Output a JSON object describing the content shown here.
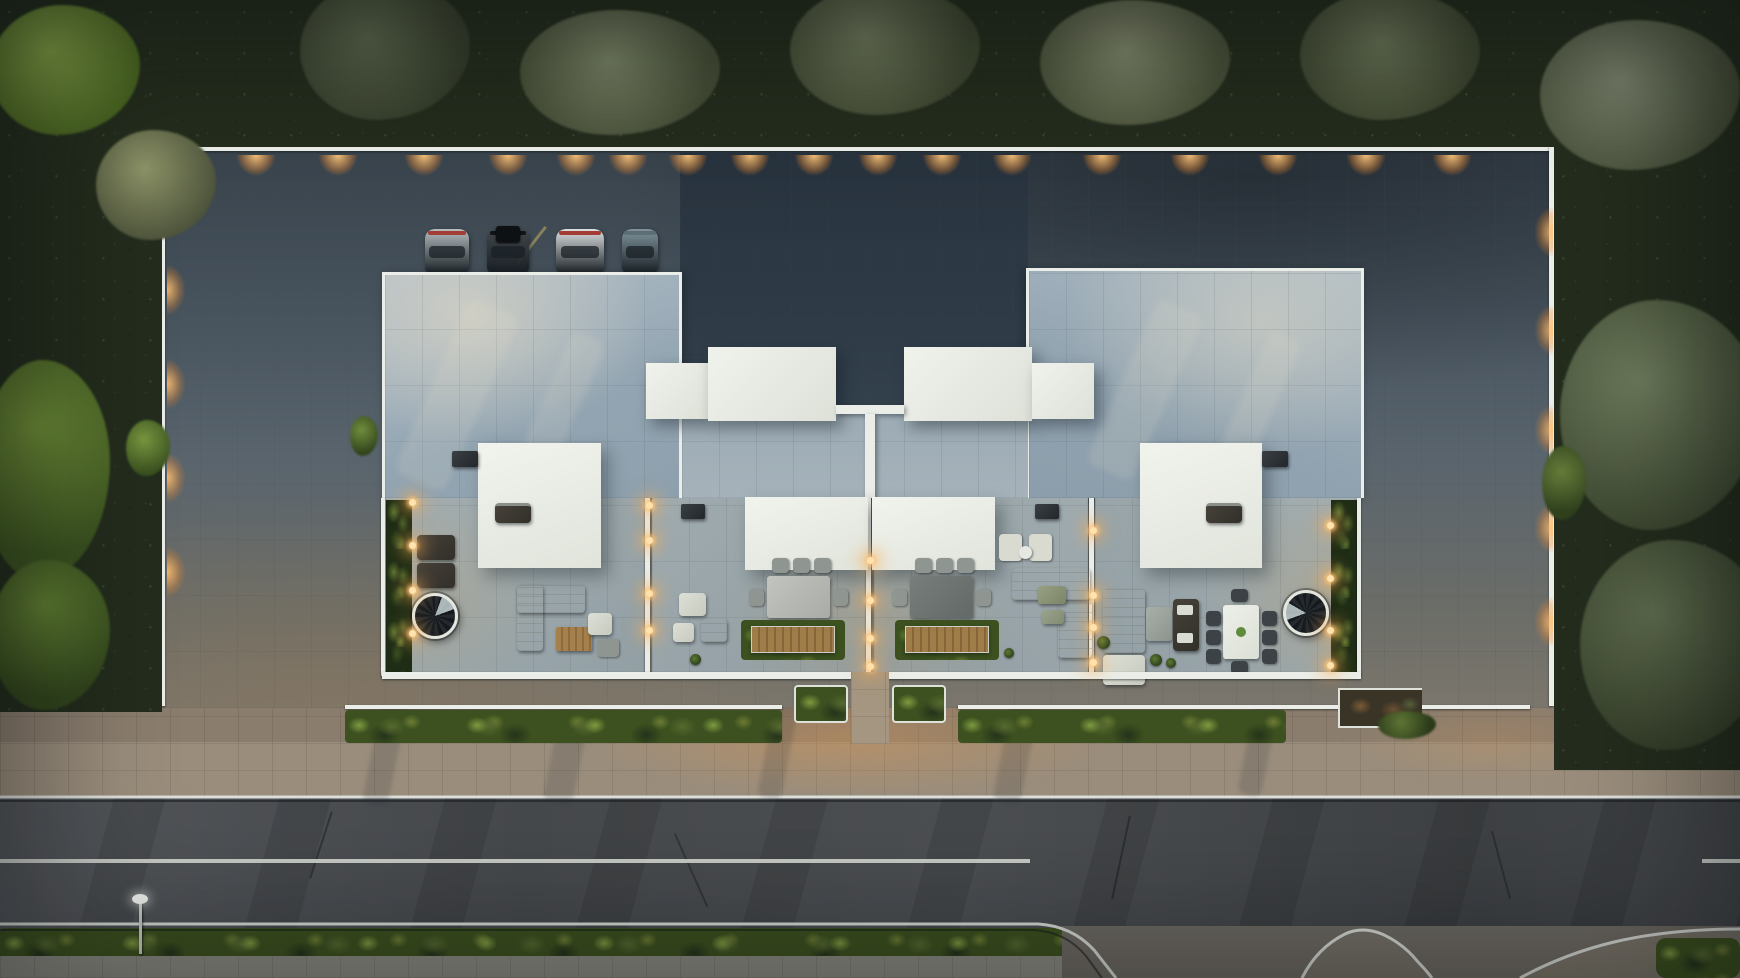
{
  "meta": {
    "description": "Aerial top-down 3D architectural visualization at dusk: a modern flat-roof residential complex with four terraced units inside a white-walled plot, surrounded by tree belts, fronted by a hedge-lined sidewalk and an asphalt road with a junction at lower right",
    "time_of_day": "dusk",
    "view": "top-down aerial",
    "visible_text": "none"
  },
  "palette": {
    "foliage-dark": "#232c1d",
    "foliage-olive": "#4e5a40",
    "foliage-bright": "#6d8c3a",
    "concrete-dark": "#3d4750",
    "concrete-mid": "#5a656e",
    "concrete-warm": "#7a746a",
    "courtyard": "#2b3843",
    "roof-tile": "#9fb0bc",
    "roof-cream": "#cbcfc6",
    "white-structure": "#eaede8",
    "terrace-tile": "#9aa7ab",
    "hedge-green": "#3c511f",
    "hedge-light": "#7e9a40",
    "sidewalk": "#9a8d7c",
    "verge": "#8a7d6e",
    "road": "#47494c",
    "road-line": "#d8dbd7",
    "glow-warm": "#ffb45e"
  },
  "counts": {
    "residential_units": 4,
    "parked_cars": 4,
    "rooftop_boxes": 4,
    "canopies": 4,
    "spiral_staircases": 2,
    "dining_sets": 3,
    "front_hedge_strips": 2,
    "entry_planters": 2,
    "street_lamps": 1,
    "lane_lines": 3
  },
  "lights": {
    "top_wall_y": 155,
    "top_wall_x": [
      256,
      338,
      424,
      508,
      576,
      628,
      688,
      750,
      814,
      878,
      942,
      1012,
      1102,
      1190,
      1278,
      1366,
      1452
    ],
    "left_wall_x": 167,
    "left_wall_y": [
      196,
      290,
      384,
      478,
      572
    ],
    "right_wall_x": 1533,
    "right_wall_y": [
      232,
      330,
      430,
      528,
      622
    ],
    "divider_columns": [
      {
        "x": 412,
        "ys": [
          502,
          545,
          590,
          633
        ]
      },
      {
        "x": 649,
        "ys": [
          505,
          540,
          593,
          630
        ]
      },
      {
        "x": 870,
        "ys": [
          560,
          600,
          638,
          666
        ]
      },
      {
        "x": 1093,
        "ys": [
          530,
          595,
          627,
          662
        ]
      },
      {
        "x": 1330,
        "ys": [
          525,
          578,
          630,
          665
        ]
      }
    ]
  },
  "cars": [
    {
      "x": 425,
      "w": 44,
      "body": "#b6bdc1",
      "accent": "#a33c34",
      "roof_box": false
    },
    {
      "x": 487,
      "w": 42,
      "body": "#41464b",
      "accent": "#111315",
      "roof_box": true
    },
    {
      "x": 556,
      "w": 48,
      "body": "#dde1e2",
      "accent": "#a33c34",
      "roof_box": false
    },
    {
      "x": 622,
      "w": 36,
      "body": "#7f949c",
      "accent": "#5d6e75",
      "roof_box": false
    }
  ],
  "street": {
    "lane_line_segments_x": [
      [
        0,
        1030
      ],
      [
        1702,
        1740
      ]
    ],
    "street_lamp": {
      "x": 140,
      "y": 900
    },
    "junction": "side street mouth and curved sweep at bottom right"
  },
  "terraces": [
    {
      "id": "unit-1",
      "features": [
        "planter-strip",
        "wall-lights",
        "two-sun-loungers",
        "spiral-staircase",
        "corner-sofa",
        "wood-coffee-table",
        "side-table",
        "armchair",
        "bbq-grill",
        "vent-box",
        "white-canopy"
      ]
    },
    {
      "id": "unit-2",
      "features": [
        "armchair",
        "bench-seat",
        "side-table",
        "dining-table-6-chairs",
        "slatted-planter-deck",
        "white-canopy",
        "vent-box",
        "wall-lights"
      ]
    },
    {
      "id": "unit-3",
      "features": [
        "lounge-chair-pair",
        "round-side-table",
        "corner-sofa",
        "green-coffee-table",
        "ottoman",
        "dining-table-6-chairs",
        "slatted-planter-deck",
        "white-canopy",
        "vent-box",
        "wall-lights"
      ]
    },
    {
      "id": "unit-4",
      "features": [
        "chaise-sofa",
        "concrete-coffee-table",
        "slatted-bench",
        "dining-table-8-chairs",
        "spiral-staircase",
        "potted-plants",
        "planter-strip",
        "bbq-grill",
        "white-canopy",
        "vent-box",
        "wall-lights"
      ]
    }
  ]
}
